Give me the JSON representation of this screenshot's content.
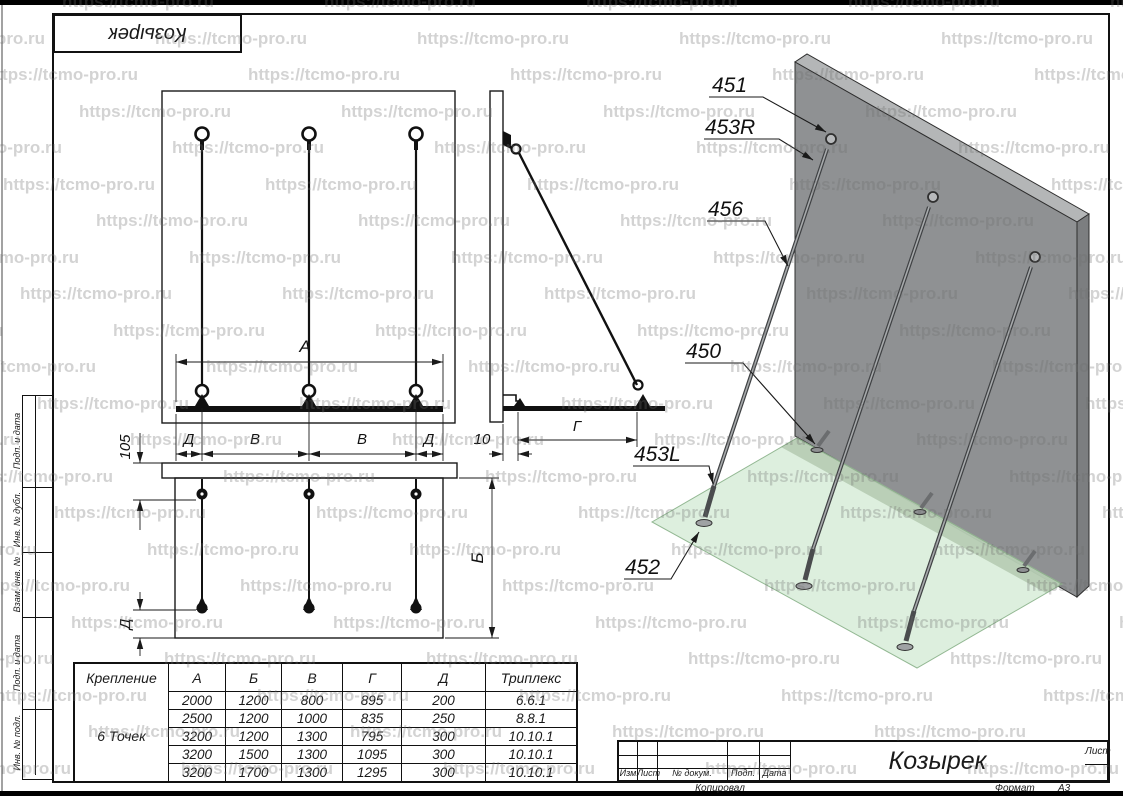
{
  "watermark": {
    "text": "https://tcmo-pro.ru"
  },
  "stamp_top": {
    "title": "Козырек"
  },
  "dims": {
    "a": "А",
    "b": "Б",
    "v": "В",
    "g": "Г",
    "d": "Д",
    "v105": "105",
    "v10": "10"
  },
  "callouts": [
    {
      "label": "451"
    },
    {
      "label": "453R"
    },
    {
      "label": "456"
    },
    {
      "label": "450"
    },
    {
      "label": "453L"
    },
    {
      "label": "452"
    }
  ],
  "table": {
    "headers": [
      "Крепление",
      "А",
      "Б",
      "В",
      "Г",
      "Д",
      "Триплекс"
    ],
    "group_label": "6 Точек",
    "rows": [
      [
        "2000",
        "1200",
        "800",
        "895",
        "200",
        "6.6.1"
      ],
      [
        "2500",
        "1200",
        "1000",
        "835",
        "250",
        "8.8.1"
      ],
      [
        "3200",
        "1200",
        "1300",
        "795",
        "300",
        "10.10.1"
      ],
      [
        "3200",
        "1500",
        "1300",
        "1095",
        "300",
        "10.10.1"
      ],
      [
        "3200",
        "1700",
        "1300",
        "1295",
        "300",
        "10.10.1"
      ]
    ]
  },
  "title_block": {
    "title": "Козырек",
    "labels": {
      "izm": "Изм",
      "list": "Лист",
      "doc": "№ докум.",
      "podp": "Подп.",
      "data": "Дата",
      "sheet": "Лист"
    },
    "footer": {
      "copied": "Копировал",
      "format_label": "Формат",
      "format_value": "А3"
    }
  },
  "side_labels": [
    "Подп. и дата",
    "Инв. № дубл.",
    "Взам. инв. №",
    "Подп. и дата",
    "Инв. № подл."
  ]
}
